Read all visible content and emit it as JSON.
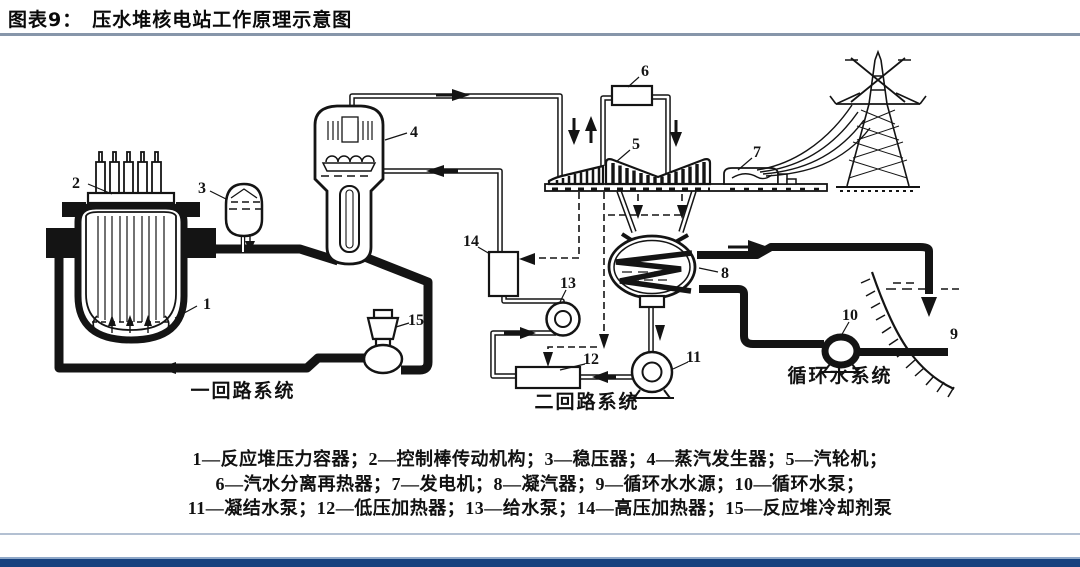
{
  "page": {
    "figure_label": "图表9：",
    "figure_title": "压水堆核电站工作原理示意图"
  },
  "diagram": {
    "component_numbers": [
      "1",
      "2",
      "3",
      "4",
      "5",
      "6",
      "7",
      "8",
      "9",
      "10",
      "11",
      "12",
      "13",
      "14",
      "15"
    ],
    "section_labels": {
      "primary_loop": "一回路系统",
      "secondary_loop": "二回路系统",
      "circulating_water": "循环水系统"
    }
  },
  "legend": {
    "lines": [
      "1—反应堆压力容器；2—控制棒传动机构；3—稳压器；4—蒸汽发生器；5—汽轮机；",
      "6—汽水分离再热器；7—发电机；8—凝汽器；9—循环水水源；10—循环水泵；",
      "11—凝结水泵；12—低压加热器；13—给水泵；14—高压加热器；15—反应堆冷却剂泵"
    ]
  },
  "colors": {
    "ink": "#141414",
    "title_rule": "#8796aa",
    "footer_rule": "#b3c0d2",
    "footer_bar_light": "#8fa8c8",
    "footer_bar_dark": "#16417e"
  }
}
